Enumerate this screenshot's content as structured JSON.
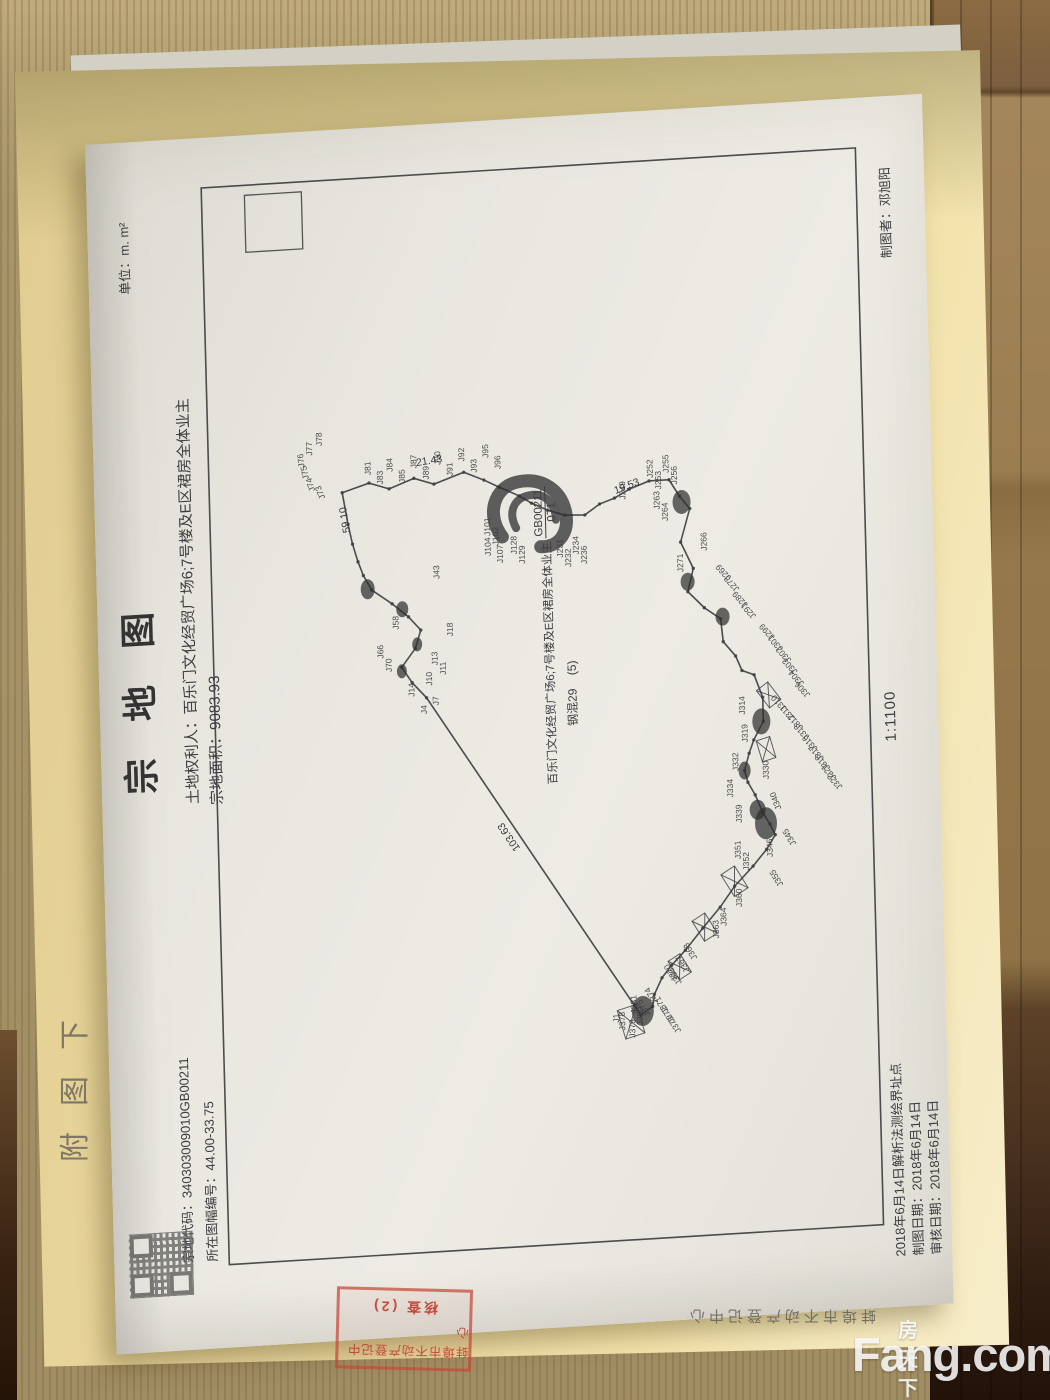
{
  "watermark": {
    "brand_cn": "房天下",
    "brand_en": "Fang.com"
  },
  "folder": {
    "org_print_text": "蚌埠市不动产登记中心",
    "side_label": "附图下",
    "stamp": {
      "line1": "蚌埠市不动产登记中心",
      "line2": "核查 (2)"
    }
  },
  "document": {
    "title": "宗 地 图",
    "unit_label": "单位：m. m²",
    "owner_line": "土地权利人：百乐门文化经贸广场6;7号楼及E区裙房全体业主",
    "area_line": "宗地面积：9083.93",
    "code_line": "宗地代码：340303009010GB00211",
    "sheet_line": "所在图幅编号：44.00-33.75",
    "cartographer_line": "制图者：邓旭阳",
    "scale": "1:1100",
    "footer_lines": [
      "2018年6月14日解析法测绘界址点",
      "制图日期：2018年6月14日",
      "审核日期：2018年6月14日"
    ],
    "parcel_text": "百乐门文化经贸广场6;7号楼及E区裙房全体业主",
    "parcel_code_num": "GB00211",
    "parcel_code_den": "071",
    "structure_label": "钢混29",
    "structure_suffix": "(5)",
    "map": {
      "frame": {
        "x": 83,
        "y": 115,
        "w": 1077,
        "h": 655
      },
      "inner_square": {
        "x": 1093,
        "y": 158,
        "w": 57,
        "h": 57
      },
      "polygon": "847,248 855,275 848,295 857,320 850,340 860,370 851,390 843,405 833,425 825,437 817,453 811,470 810,490 820,505 825,520 833,535 840,555 840,575 823,585 810,595 777,585 750,597 727,591 710,607 698,623 675,625 660,637 645,643 640,655 617,663 593,663 575,653 562,648 545,643 533,646 520,653 502,660 490,667 479,672 465,663 449,649 430,630 410,615 390,597 369,579 355,565 343,555 327,547 315,545 307,533 637,327 653,313 669,303 687,317 705,323 719,311 733,295 748,275 763,267 777,262 795,257 815,253",
      "edge_labels": [
        [
          "21.43",
          869,
          323,
          84
        ],
        [
          "19.53",
          829,
          521,
          72
        ],
        [
          "59.10",
          807,
          255,
          -8
        ],
        [
          "103.63",
          481,
          417,
          -32
        ]
      ],
      "point_labels": [
        [
          "J73",
          843,
          231,
          -20
        ],
        [
          "J74",
          851,
          221,
          -15
        ],
        [
          "J75",
          863,
          215,
          -10
        ],
        [
          "J76",
          875,
          211,
          -5
        ],
        [
          "J77",
          886,
          219,
          0
        ],
        [
          "J78",
          895,
          229,
          0
        ],
        [
          "J81",
          863,
          277,
          0
        ],
        [
          "J83",
          853,
          289,
          0
        ],
        [
          "J84",
          865,
          299,
          0
        ],
        [
          "J85",
          853,
          311,
          0
        ],
        [
          "J87",
          867,
          323,
          0
        ],
        [
          "J89",
          855,
          335,
          0
        ],
        [
          "J90",
          869,
          347,
          0
        ],
        [
          "J91",
          857,
          359,
          0
        ],
        [
          "J92",
          871,
          371,
          0
        ],
        [
          "J93",
          859,
          383,
          0
        ],
        [
          "J95",
          873,
          395,
          0
        ],
        [
          "J96",
          861,
          407,
          0
        ],
        [
          "J101",
          795,
          395,
          0
        ],
        [
          "J102",
          785,
          403,
          0
        ],
        [
          "J104",
          775,
          395,
          0
        ],
        [
          "J107",
          767,
          407,
          0
        ],
        [
          "J128",
          775,
          421,
          0
        ],
        [
          "J129",
          765,
          429,
          0
        ],
        [
          "J231",
          769,
          467,
          0
        ],
        [
          "J232",
          759,
          475,
          0
        ],
        [
          "J234",
          771,
          483,
          0
        ],
        [
          "J236",
          761,
          491,
          0
        ],
        [
          "J249",
          823,
          531,
          0
        ],
        [
          "J252",
          843,
          559,
          0
        ],
        [
          "J253",
          831,
          567,
          0
        ],
        [
          "J255",
          847,
          575,
          0
        ],
        [
          "J256",
          835,
          583,
          0
        ],
        [
          "J263",
          811,
          565,
          0
        ],
        [
          "J264",
          799,
          573,
          0
        ],
        [
          "J266",
          767,
          611,
          0
        ],
        [
          "J271",
          747,
          587,
          0
        ],
        [
          "J269",
          739,
          635,
          -40
        ],
        [
          "J278",
          727,
          643,
          -40
        ],
        [
          "J289",
          711,
          651,
          -40
        ],
        [
          "J291",
          699,
          659,
          -40
        ],
        [
          "J299",
          677,
          677,
          -40
        ],
        [
          "J301",
          665,
          685,
          -40
        ],
        [
          "J302",
          653,
          693,
          -40
        ],
        [
          "J303",
          641,
          699,
          -40
        ],
        [
          "J304",
          629,
          705,
          -40
        ],
        [
          "J306",
          617,
          711,
          -40
        ],
        [
          "J310",
          605,
          687,
          -40
        ],
        [
          "J311",
          595,
          695,
          -40
        ],
        [
          "J312",
          585,
          703,
          -40
        ],
        [
          "J313",
          575,
          709,
          -40
        ],
        [
          "J314",
          601,
          645,
          0
        ],
        [
          "J316",
          563,
          717,
          -40
        ],
        [
          "J317",
          553,
          723,
          -40
        ],
        [
          "J318",
          543,
          729,
          -40
        ],
        [
          "J319",
          573,
          647,
          0
        ],
        [
          "J321",
          533,
          735,
          -40
        ],
        [
          "J322",
          523,
          741,
          -40
        ],
        [
          "J330",
          535,
          667,
          0
        ],
        [
          "J332",
          545,
          637,
          0
        ],
        [
          "J334",
          519,
          631,
          0
        ],
        [
          "J339",
          493,
          639,
          0
        ],
        [
          "J340",
          505,
          679,
          -20
        ],
        [
          "J345",
          469,
          693,
          -30
        ],
        [
          "J346",
          457,
          669,
          0
        ],
        [
          "J351",
          457,
          637,
          0
        ],
        [
          "J352",
          445,
          645,
          0
        ],
        [
          "J355",
          429,
          679,
          -30
        ],
        [
          "J360",
          409,
          637,
          0
        ],
        [
          "J363",
          379,
          613,
          0
        ],
        [
          "J364",
          391,
          621,
          0
        ],
        [
          "J366",
          337,
          575,
          -30
        ],
        [
          "J367",
          349,
          583,
          -30
        ],
        [
          "J368",
          361,
          591,
          -30
        ],
        [
          "J370",
          341,
          571,
          -30
        ],
        [
          "J371",
          309,
          561,
          -30
        ],
        [
          "J372",
          299,
          567,
          -30
        ],
        [
          "J373",
          289,
          573,
          -30
        ],
        [
          "J374",
          319,
          551,
          -30
        ],
        [
          "J375",
          307,
          543,
          -30
        ],
        [
          "J378",
          293,
          517,
          0
        ],
        [
          "J379",
          285,
          527,
          0
        ],
        [
          "J380",
          297,
          535,
          0
        ],
        [
          "J381",
          309,
          529,
          0
        ],
        [
          "J1",
          301,
          511,
          0
        ],
        [
          "J70",
          665,
          293,
          0
        ],
        [
          "J66",
          679,
          285,
          0
        ],
        [
          "J58",
          707,
          301,
          0
        ],
        [
          "J43",
          755,
          343,
          0
        ],
        [
          "J18",
          697,
          355,
          0
        ],
        [
          "J13",
          669,
          339,
          0
        ],
        [
          "J11",
          659,
          347,
          0
        ],
        [
          "J10",
          649,
          333,
          0
        ],
        [
          "J7",
          629,
          339,
          0
        ],
        [
          "J14",
          639,
          315,
          0
        ],
        [
          "J4",
          621,
          327,
          0
        ]
      ],
      "blobs": [
        [
          817,
          587,
          12,
          9
        ],
        [
          737,
          591,
          9,
          7
        ],
        [
          700,
          625,
          9,
          7
        ],
        [
          593,
          661,
          13,
          9
        ],
        [
          491,
          663,
          16,
          11
        ],
        [
          311,
          535,
          15,
          11
        ],
        [
          749,
          271,
          10,
          7
        ],
        [
          727,
          305,
          8,
          6
        ],
        [
          691,
          319,
          7,
          5
        ],
        [
          665,
          303,
          7,
          5
        ],
        [
          505,
          655,
          10,
          8
        ],
        [
          545,
          643,
          9,
          6
        ]
      ],
      "arcs": [
        "M793,407 C815,391 843,399 847,423 C851,447 837,467 813,471 C793,474 779,463 781,445",
        "M801,421 C817,413 831,419 833,435 C835,451 823,461 807,461"
      ],
      "hatches": [
        [
          435,
          630,
          26,
          16,
          -30
        ],
        [
          391,
          599,
          24,
          15,
          -30
        ],
        [
          353,
          573,
          22,
          14,
          -30
        ],
        [
          301,
          523,
          30,
          20,
          -15
        ],
        [
          565,
          665,
          22,
          14,
          -15
        ],
        [
          619,
          669,
          22,
          14,
          -35
        ]
      ]
    }
  }
}
